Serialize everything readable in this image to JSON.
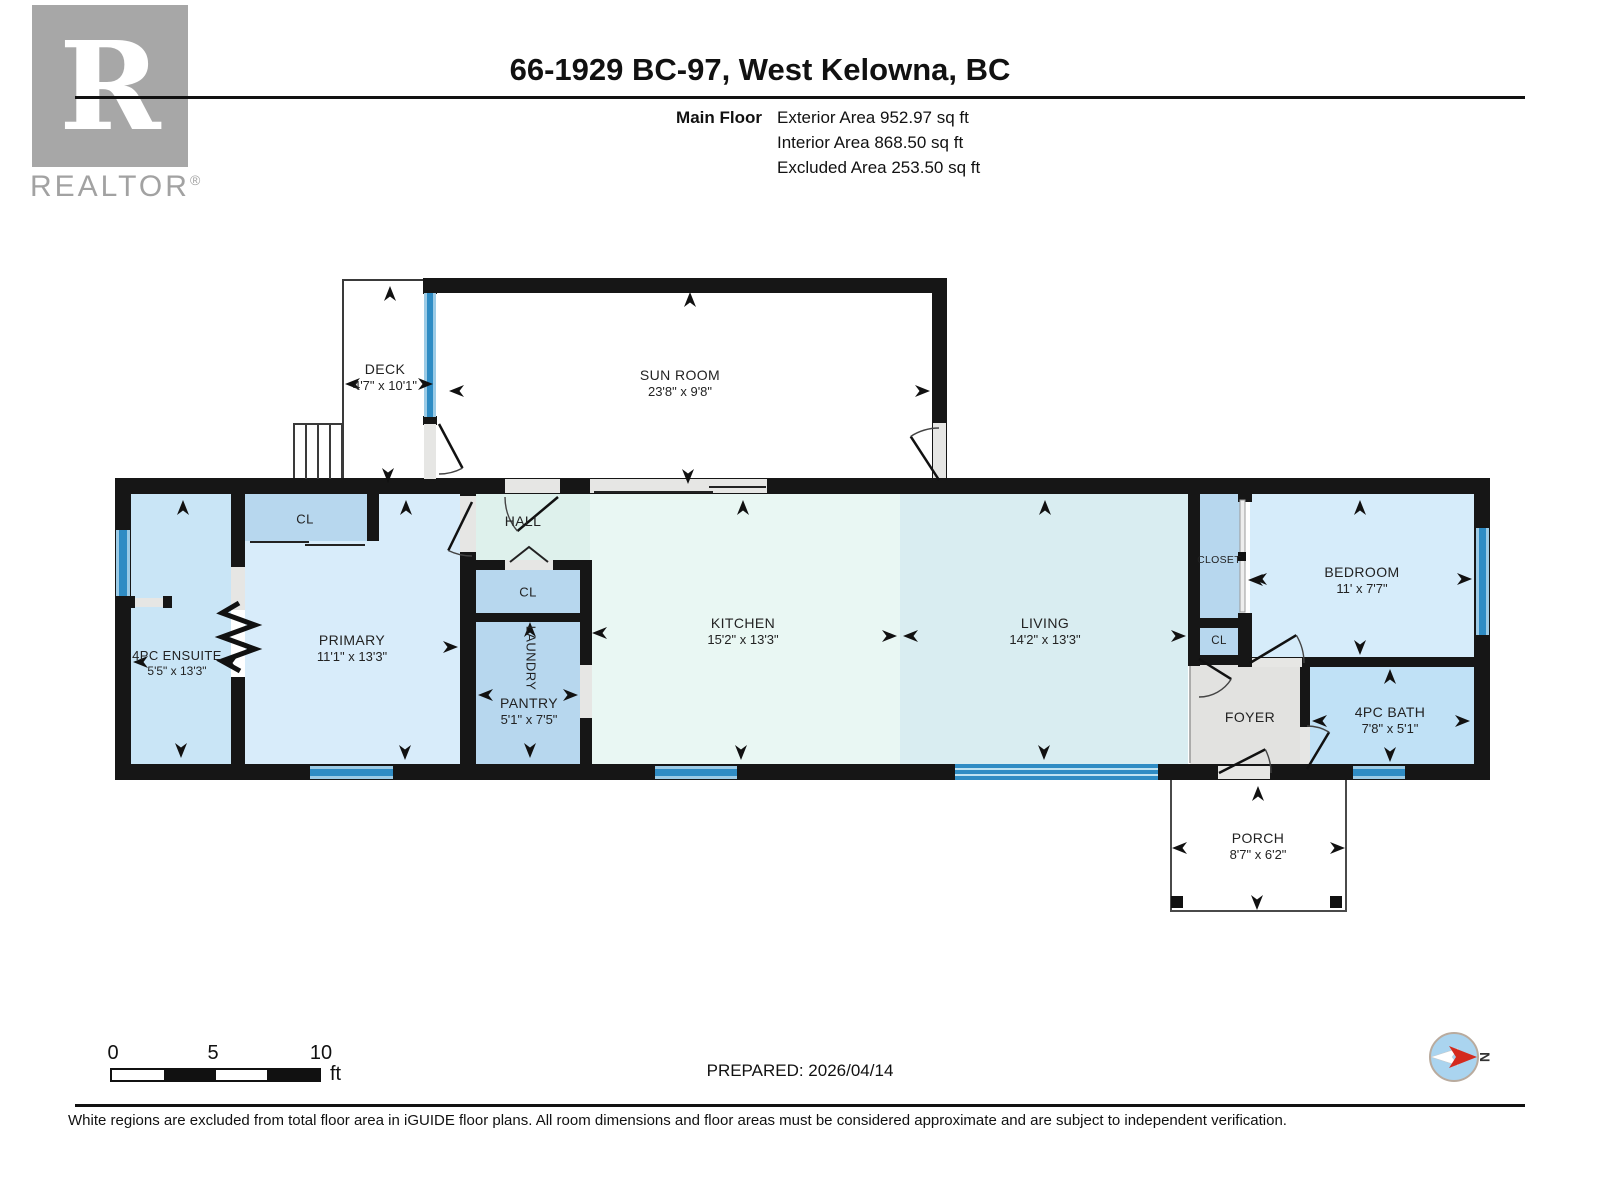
{
  "branding": {
    "logo_letter": "R",
    "logo_wordmark": "REALTOR",
    "registered_mark": "®"
  },
  "header": {
    "title": "66-1929 BC-97, West Kelowna, BC",
    "floor_label": "Main Floor",
    "area_lines": [
      "Exterior Area 952.97 sq ft",
      "Interior Area 868.50 sq ft",
      "Excluded Area 253.50 sq ft"
    ]
  },
  "rooms": {
    "deck": {
      "name": "DECK",
      "dims": "4'7\" x 10'1\""
    },
    "sunroom": {
      "name": "SUN ROOM",
      "dims": "23'8\" x 9'8\""
    },
    "ensuite": {
      "name": "4PC ENSUITE",
      "dims": "5'5\" x 13'3\""
    },
    "primary_closet": {
      "name": "CL"
    },
    "primary": {
      "name": "PRIMARY",
      "dims": "11'1\" x 13'3\""
    },
    "hall": {
      "name": "HALL"
    },
    "hall_closet": {
      "name": "CL"
    },
    "laundry": {
      "name": "LAUNDRY"
    },
    "pantry": {
      "name": "PANTRY",
      "dims": "5'1\" x 7'5\""
    },
    "kitchen": {
      "name": "KITCHEN",
      "dims": "15'2\" x 13'3\""
    },
    "living": {
      "name": "LIVING",
      "dims": "14'2\" x 13'3\""
    },
    "closet": {
      "name": "CLOSET"
    },
    "foyer_closet": {
      "name": "CL"
    },
    "bedroom": {
      "name": "BEDROOM",
      "dims": "11' x 7'7\""
    },
    "bath": {
      "name": "4PC BATH",
      "dims": "7'8\" x 5'1\""
    },
    "foyer": {
      "name": "FOYER"
    },
    "porch": {
      "name": "PORCH",
      "dims": "8'7\" x 6'2\""
    }
  },
  "scale_bar": {
    "ticks": [
      "0",
      "5",
      "10"
    ],
    "unit": "ft"
  },
  "annotations": {
    "prepared": "PREPARED: 2026/04/14",
    "compass_label": "N"
  },
  "footer": {
    "disclaimer": "White regions are excluded from total floor area in iGUIDE floor plans. All room dimensions and floor areas must be considered approximate and are subject to independent verification."
  },
  "colors": {
    "wall": "#161616",
    "window_blue": "#2f8cc4",
    "window_light": "#9ccbe6",
    "ensuite_blue": "#c9e5f6",
    "primary_blue": "#d8ecfa",
    "closet_blue": "#b7d7ee",
    "bath_blue": "#c0e1f6",
    "bedroom_blue": "#d6ecfa",
    "kitchen_mint": "#e9f7f3",
    "living_cyan": "#d9edf1",
    "hall_teal": "#def1ec",
    "foyer_gray": "#e2e2e0",
    "compass_red": "#d42a1e",
    "logo_gray": "#a7a7a7"
  }
}
